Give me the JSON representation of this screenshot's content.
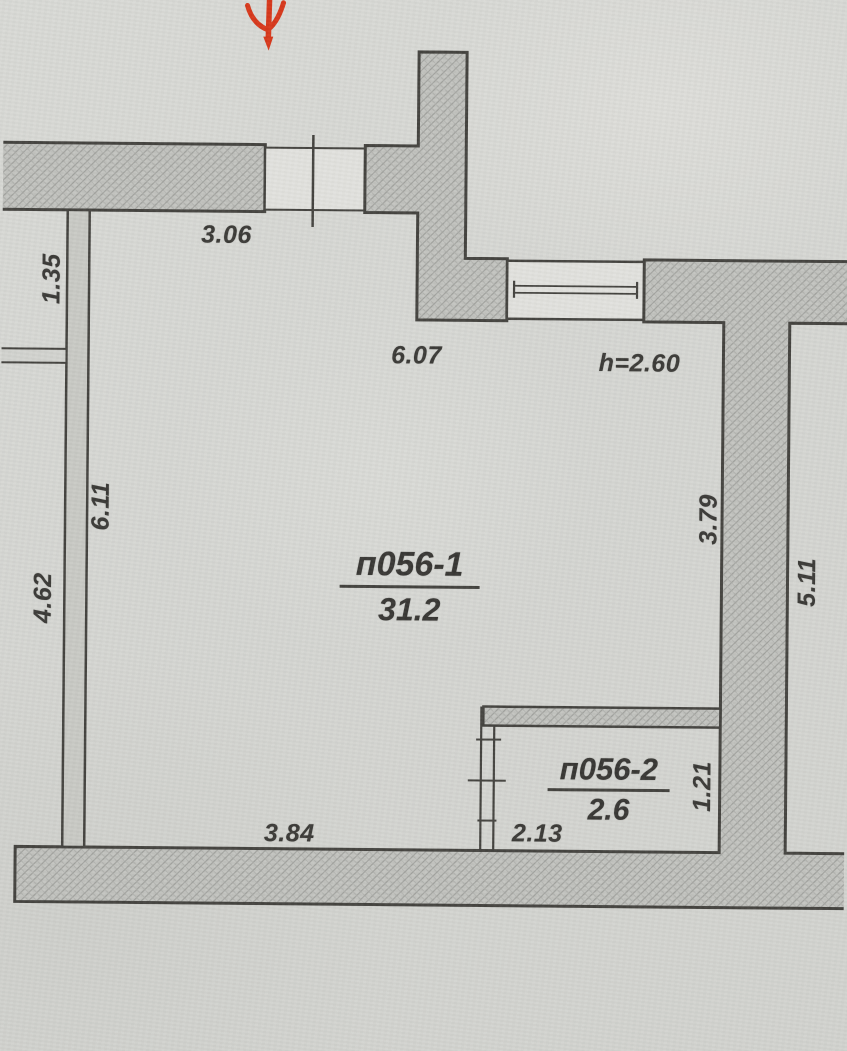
{
  "document": {
    "type": "scanned apartment floor plan"
  },
  "colors": {
    "paper": "#d6d7d3",
    "wall_fill": "#c3c4c0",
    "wall_hatch": "#a2a39f",
    "ink": "#454440",
    "text_ink": "#3c3b38",
    "opening_fill": "#e2e2de",
    "arrow_red": "#d8391c"
  },
  "icons": {
    "entrance_arrow": "red-down-arrow"
  },
  "rooms": [
    {
      "name": "п056-1",
      "area": "31.2"
    },
    {
      "name": "п056-2",
      "area": "2.6"
    }
  ],
  "annotations": {
    "ceiling_height": "h=2.60"
  },
  "dimensions": {
    "top_wall_width": "3.06",
    "left_niche_height": "1.35",
    "room1_width": "6.07",
    "room1_left_height": "6.11",
    "left_corridor_height": "4.62",
    "room1_right_height": "3.79",
    "neighbor_room_height": "5.11",
    "room2_height": "1.21",
    "room2_width": "2.13",
    "room1_bottom_width": "3.84"
  }
}
